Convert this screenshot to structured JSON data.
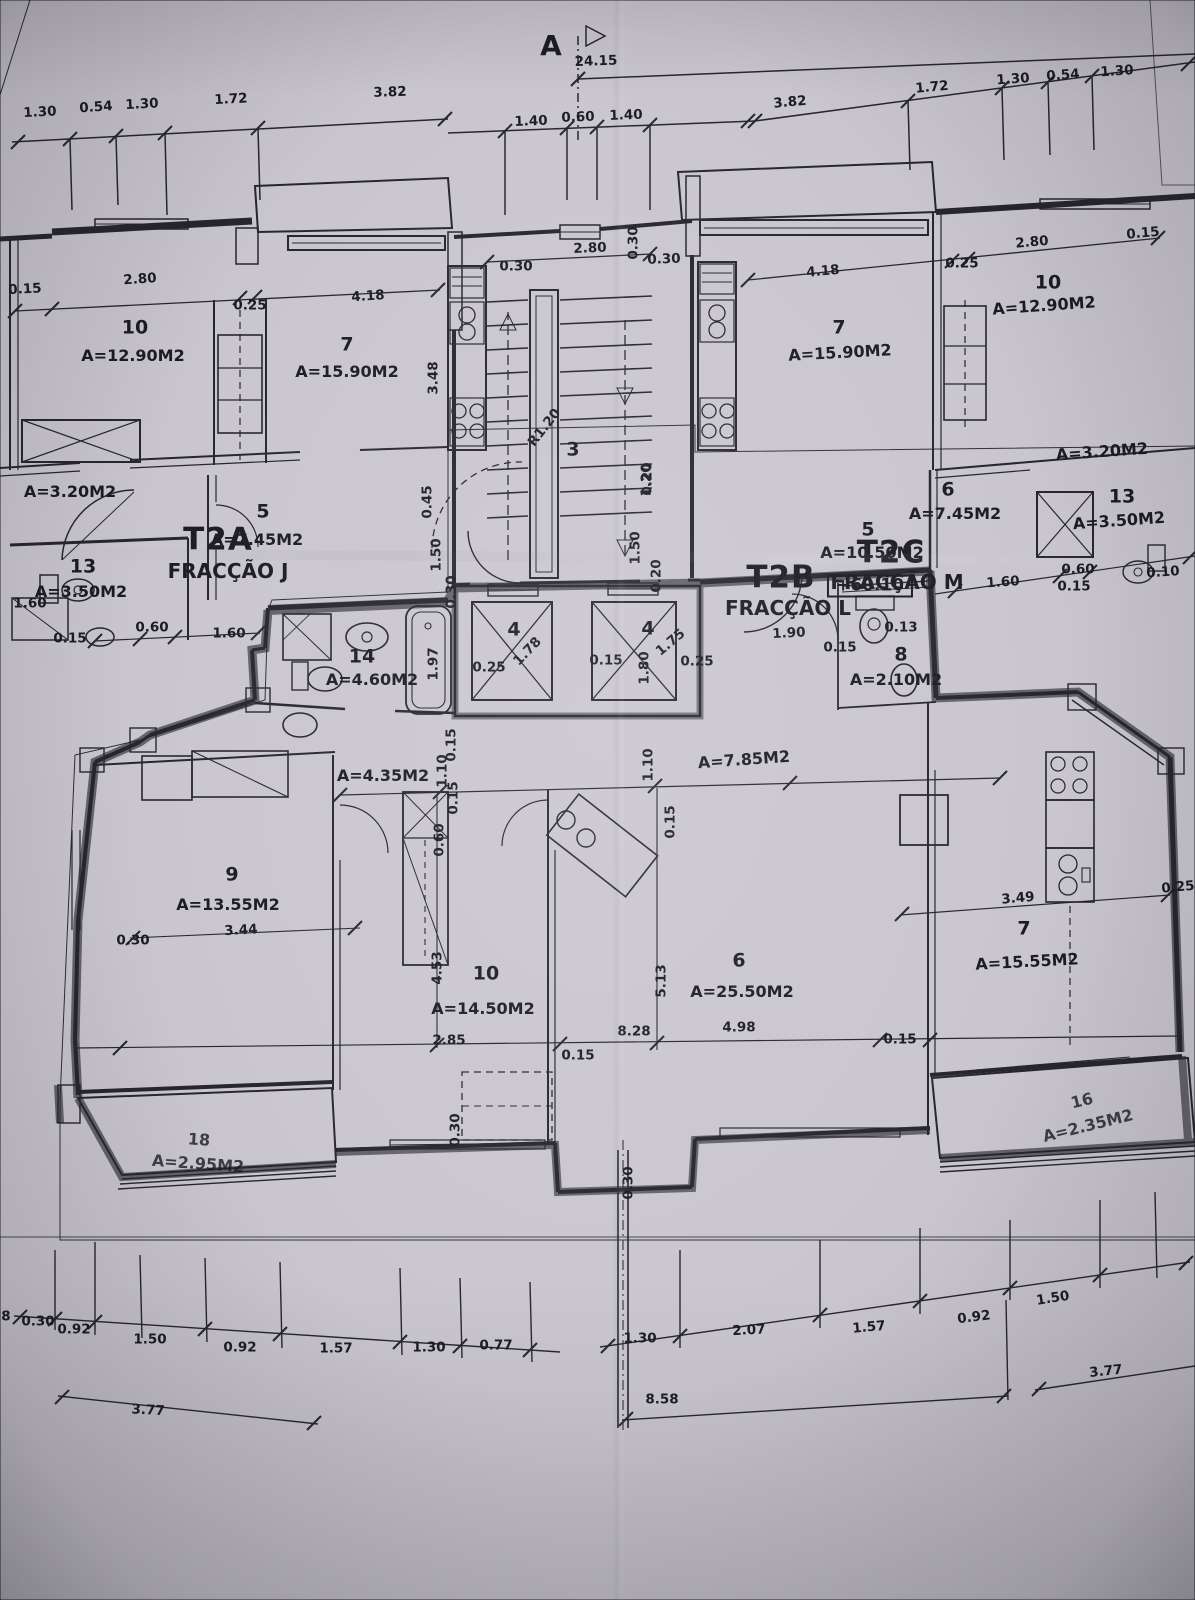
{
  "colors": {
    "paper": "#cac6cf",
    "paper_lower": "#c7cbd1",
    "ink": "#26262c",
    "label_ink": "#1b1b22",
    "highlight_green": "#d2e5de",
    "highlight_orange": "#ee9a31"
  },
  "plan": {
    "labels": {
      "top": [
        {
          "t": "A",
          "x": 551,
          "y": 46,
          "k": "marker"
        },
        {
          "t": "24.15",
          "x": 596,
          "y": 62,
          "r": -2,
          "k": "dim"
        },
        {
          "t": "1.30",
          "x": 40,
          "y": 113,
          "r": -3,
          "k": "dim"
        },
        {
          "t": "0.54",
          "x": 96,
          "y": 108,
          "r": -4,
          "k": "dim"
        },
        {
          "t": "1.30",
          "x": 142,
          "y": 105,
          "r": -3,
          "k": "dim"
        },
        {
          "t": "1.72",
          "x": 231,
          "y": 100,
          "r": -3,
          "k": "dim"
        },
        {
          "t": "3.82",
          "x": 390,
          "y": 93,
          "r": -2,
          "k": "dim"
        },
        {
          "t": "1.40",
          "x": 531,
          "y": 122,
          "r": -2,
          "k": "dim"
        },
        {
          "t": "0.60",
          "x": 578,
          "y": 118,
          "r": -2,
          "k": "dim"
        },
        {
          "t": "1.40",
          "x": 626,
          "y": 116,
          "r": -2,
          "k": "dim"
        },
        {
          "t": "3.82",
          "x": 790,
          "y": 103,
          "r": -5,
          "k": "dim"
        },
        {
          "t": "1.72",
          "x": 932,
          "y": 88,
          "r": -5,
          "k": "dim"
        },
        {
          "t": "1.30",
          "x": 1013,
          "y": 80,
          "r": -4,
          "k": "dim"
        },
        {
          "t": "0.54",
          "x": 1063,
          "y": 76,
          "r": -4,
          "k": "dim"
        },
        {
          "t": "1.30",
          "x": 1117,
          "y": 72,
          "r": -4,
          "k": "dim"
        }
      ],
      "upper_left": [
        {
          "t": "0.15",
          "x": 25,
          "y": 290,
          "r": -3,
          "k": "dim"
        },
        {
          "t": "2.80",
          "x": 140,
          "y": 280,
          "r": -4,
          "k": "dim"
        },
        {
          "t": "10",
          "x": 135,
          "y": 328,
          "k": "room"
        },
        {
          "t": "A=12.90M2",
          "x": 133,
          "y": 356,
          "k": "area"
        },
        {
          "t": "0.25",
          "x": 250,
          "y": 306,
          "k": "dim"
        },
        {
          "t": "4.18",
          "x": 368,
          "y": 297,
          "r": -4,
          "k": "dim"
        },
        {
          "t": "7",
          "x": 347,
          "y": 345,
          "k": "room"
        },
        {
          "t": "A=15.90M2",
          "x": 347,
          "y": 372,
          "k": "area"
        },
        {
          "t": "3.48",
          "x": 434,
          "y": 378,
          "r": -90,
          "k": "dim"
        },
        {
          "t": "0.45",
          "x": 428,
          "y": 502,
          "r": -90,
          "k": "dim"
        },
        {
          "t": "A=3.20M2",
          "x": 70,
          "y": 492,
          "k": "area"
        },
        {
          "t": "5",
          "x": 263,
          "y": 512,
          "k": "room"
        },
        {
          "t": "A=7.45M2",
          "x": 257,
          "y": 540,
          "k": "area"
        },
        {
          "t": "13",
          "x": 83,
          "y": 567,
          "k": "room"
        },
        {
          "t": "A=3.50M2",
          "x": 81,
          "y": 592,
          "k": "area"
        },
        {
          "t": "1.60",
          "x": 30,
          "y": 604,
          "k": "dim"
        },
        {
          "t": "0.15",
          "x": 70,
          "y": 639,
          "k": "dim"
        },
        {
          "t": "0.60",
          "x": 152,
          "y": 628,
          "k": "dim"
        },
        {
          "t": "1.60",
          "x": 229,
          "y": 634,
          "k": "dim"
        },
        {
          "t": "T2A",
          "x": 218,
          "y": 540,
          "k": "big"
        },
        {
          "t": "FRACÇÃO J",
          "x": 228,
          "y": 571,
          "k": "frac"
        },
        {
          "t": "1.50",
          "x": 437,
          "y": 555,
          "r": -90,
          "k": "dim"
        },
        {
          "t": "0.30",
          "x": 452,
          "y": 592,
          "r": -90,
          "k": "dim"
        }
      ],
      "stairs": [
        {
          "t": "0.30",
          "x": 516,
          "y": 267,
          "k": "dim"
        },
        {
          "t": "2.80",
          "x": 590,
          "y": 249,
          "r": -2,
          "k": "dim"
        },
        {
          "t": "0.30",
          "x": 664,
          "y": 260,
          "r": -2,
          "k": "dim"
        },
        {
          "t": "0.30",
          "x": 634,
          "y": 243,
          "r": -90,
          "k": "dim"
        },
        {
          "t": "3",
          "x": 573,
          "y": 450,
          "k": "room"
        },
        {
          "t": "R1.20",
          "x": 545,
          "y": 428,
          "r": -52,
          "k": "dim"
        },
        {
          "t": "1.20",
          "x": 647,
          "y": 480,
          "r": -90,
          "k": "dim"
        },
        {
          "t": "5",
          "x": 868,
          "y": 530,
          "k": "room"
        },
        {
          "t": "A=10.50M2",
          "x": 872,
          "y": 553,
          "k": "area"
        },
        {
          "t": "+60.10",
          "x": 870,
          "y": 586,
          "k": "level"
        },
        {
          "t": "1.50",
          "x": 636,
          "y": 548,
          "r": -90,
          "k": "dim"
        },
        {
          "t": "0.20",
          "x": 648,
          "y": 479,
          "r": -90,
          "k": "dim"
        },
        {
          "t": "0.20",
          "x": 657,
          "y": 576,
          "r": -90,
          "k": "dim"
        }
      ],
      "upper_right": [
        {
          "t": "T2B",
          "x": 781,
          "y": 578,
          "k": "big"
        },
        {
          "t": "FRACÇÃO L",
          "x": 788,
          "y": 608,
          "k": "frac"
        },
        {
          "t": "T2C",
          "x": 891,
          "y": 553,
          "k": "big"
        },
        {
          "t": "FRACÇÃO M",
          "x": 897,
          "y": 582,
          "k": "frac"
        },
        {
          "t": "6",
          "x": 948,
          "y": 490,
          "k": "room"
        },
        {
          "t": "A=7.45M2",
          "x": 955,
          "y": 514,
          "k": "area"
        },
        {
          "t": "1.60",
          "x": 1003,
          "y": 583,
          "r": -4,
          "k": "dim"
        },
        {
          "t": "4.18",
          "x": 823,
          "y": 272,
          "r": -5,
          "k": "dim"
        },
        {
          "t": "7",
          "x": 839,
          "y": 328,
          "k": "room"
        },
        {
          "t": "A=15.90M2",
          "x": 840,
          "y": 353,
          "r": -3,
          "k": "area"
        },
        {
          "t": "0.25",
          "x": 962,
          "y": 264,
          "k": "dim"
        },
        {
          "t": "2.80",
          "x": 1032,
          "y": 243,
          "r": -5,
          "k": "dim"
        },
        {
          "t": "10",
          "x": 1048,
          "y": 283,
          "k": "room"
        },
        {
          "t": "A=12.90M2",
          "x": 1044,
          "y": 306,
          "r": -4,
          "k": "area"
        },
        {
          "t": "0.15",
          "x": 1143,
          "y": 234,
          "r": -5,
          "k": "dim"
        },
        {
          "t": "A=3.20M2",
          "x": 1102,
          "y": 452,
          "r": -4,
          "k": "area"
        },
        {
          "t": "13",
          "x": 1122,
          "y": 497,
          "k": "room"
        },
        {
          "t": "A=3.50M2",
          "x": 1119,
          "y": 521,
          "r": -4,
          "k": "area"
        },
        {
          "t": "0.60",
          "x": 1078,
          "y": 570,
          "k": "dim"
        },
        {
          "t": "0.15",
          "x": 1074,
          "y": 587,
          "k": "dim"
        },
        {
          "t": "0.10",
          "x": 1163,
          "y": 573,
          "r": -4,
          "k": "dim"
        }
      ],
      "apartment": [
        {
          "t": "14",
          "x": 362,
          "y": 657,
          "k": "room"
        },
        {
          "t": "A=4.60M2",
          "x": 372,
          "y": 680,
          "k": "area"
        },
        {
          "t": "1.97",
          "x": 434,
          "y": 664,
          "r": -90,
          "k": "dim"
        },
        {
          "t": "0.25",
          "x": 489,
          "y": 668,
          "k": "dim"
        },
        {
          "t": "4",
          "x": 514,
          "y": 630,
          "k": "room"
        },
        {
          "t": "1.78",
          "x": 528,
          "y": 652,
          "r": -46,
          "k": "dim"
        },
        {
          "t": "0.15",
          "x": 606,
          "y": 661,
          "k": "dim"
        },
        {
          "t": "4",
          "x": 648,
          "y": 629,
          "k": "room"
        },
        {
          "t": "1.75",
          "x": 671,
          "y": 643,
          "r": -40,
          "k": "dim"
        },
        {
          "t": "1.80",
          "x": 645,
          "y": 668,
          "r": -90,
          "k": "dim"
        },
        {
          "t": "0.25",
          "x": 697,
          "y": 662,
          "k": "dim"
        },
        {
          "t": "1.90",
          "x": 789,
          "y": 634,
          "r": -3,
          "k": "dim"
        },
        {
          "t": "0.15",
          "x": 840,
          "y": 648,
          "k": "dim"
        },
        {
          "t": "0.13",
          "x": 901,
          "y": 628,
          "k": "dim"
        },
        {
          "t": "8",
          "x": 901,
          "y": 655,
          "k": "room"
        },
        {
          "t": "A=2.10M2",
          "x": 896,
          "y": 680,
          "k": "area"
        },
        {
          "t": "A=4.35M2",
          "x": 383,
          "y": 776,
          "k": "area"
        },
        {
          "t": "0.15",
          "x": 452,
          "y": 745,
          "r": -90,
          "k": "dim"
        },
        {
          "t": "1.10",
          "x": 443,
          "y": 771,
          "r": -90,
          "k": "dim"
        },
        {
          "t": "0.15",
          "x": 454,
          "y": 798,
          "r": -90,
          "k": "dim"
        },
        {
          "t": "0.60",
          "x": 440,
          "y": 840,
          "r": -90,
          "k": "dim"
        },
        {
          "t": "A=7.85M2",
          "x": 744,
          "y": 760,
          "r": -4,
          "k": "area"
        },
        {
          "t": "1.10",
          "x": 649,
          "y": 765,
          "r": -90,
          "k": "dim"
        },
        {
          "t": "0.15",
          "x": 671,
          "y": 822,
          "r": -90,
          "k": "dim"
        },
        {
          "t": "9",
          "x": 232,
          "y": 875,
          "k": "room"
        },
        {
          "t": "A=13.55M2",
          "x": 228,
          "y": 905,
          "k": "area"
        },
        {
          "t": "3.44",
          "x": 241,
          "y": 931,
          "r": -3,
          "k": "dim"
        },
        {
          "t": "0.30",
          "x": 133,
          "y": 941,
          "k": "dim"
        },
        {
          "t": "4.53",
          "x": 438,
          "y": 968,
          "r": -90,
          "k": "dim"
        },
        {
          "t": "10",
          "x": 486,
          "y": 974,
          "k": "room"
        },
        {
          "t": "A=14.50M2",
          "x": 483,
          "y": 1009,
          "k": "area"
        },
        {
          "t": "2.85",
          "x": 449,
          "y": 1041,
          "k": "dim"
        },
        {
          "t": "0.15",
          "x": 578,
          "y": 1056,
          "k": "dim"
        },
        {
          "t": "8.28",
          "x": 634,
          "y": 1032,
          "k": "dim"
        },
        {
          "t": "5.13",
          "x": 662,
          "y": 981,
          "r": -90,
          "k": "dim"
        },
        {
          "t": "6",
          "x": 739,
          "y": 961,
          "k": "room"
        },
        {
          "t": "A=25.50M2",
          "x": 742,
          "y": 992,
          "k": "area"
        },
        {
          "t": "4.98",
          "x": 739,
          "y": 1028,
          "k": "dim"
        },
        {
          "t": "0.15",
          "x": 900,
          "y": 1040,
          "k": "dim"
        },
        {
          "t": "3.49",
          "x": 1018,
          "y": 899,
          "r": -5,
          "k": "dim"
        },
        {
          "t": "7",
          "x": 1024,
          "y": 929,
          "k": "room"
        },
        {
          "t": "A=15.55M2",
          "x": 1027,
          "y": 962,
          "r": -3,
          "k": "area"
        },
        {
          "t": "0.25",
          "x": 1178,
          "y": 888,
          "r": -5,
          "k": "dim"
        },
        {
          "t": "16",
          "x": 1082,
          "y": 1101,
          "r": -14,
          "k": "balc"
        },
        {
          "t": "A=2.35M2",
          "x": 1088,
          "y": 1126,
          "r": -14,
          "k": "balc"
        },
        {
          "t": "18",
          "x": 199,
          "y": 1140,
          "r": 4,
          "k": "balc"
        },
        {
          "t": "A=2.95M2",
          "x": 198,
          "y": 1164,
          "r": 4,
          "k": "balc"
        },
        {
          "t": "0.30",
          "x": 456,
          "y": 1130,
          "r": -90,
          "k": "dim"
        },
        {
          "t": "0.30",
          "x": 629,
          "y": 1183,
          "r": -90,
          "k": "dim"
        }
      ],
      "bottom": [
        {
          "t": "8",
          "x": 6,
          "y": 1317,
          "k": "dim"
        },
        {
          "t": "0.30",
          "x": 38,
          "y": 1322,
          "k": "dim"
        },
        {
          "t": "0.92",
          "x": 74,
          "y": 1330,
          "k": "dim"
        },
        {
          "t": "1.50",
          "x": 150,
          "y": 1340,
          "k": "dim"
        },
        {
          "t": "0.92",
          "x": 240,
          "y": 1348,
          "k": "dim"
        },
        {
          "t": "1.57",
          "x": 336,
          "y": 1349,
          "k": "dim"
        },
        {
          "t": "1.30",
          "x": 429,
          "y": 1348,
          "k": "dim"
        },
        {
          "t": "0.77",
          "x": 496,
          "y": 1346,
          "k": "dim"
        },
        {
          "t": "1.30",
          "x": 640,
          "y": 1339,
          "k": "dim"
        },
        {
          "t": "2.07",
          "x": 749,
          "y": 1331,
          "r": -3,
          "k": "dim"
        },
        {
          "t": "1.57",
          "x": 869,
          "y": 1328,
          "r": -5,
          "k": "dim"
        },
        {
          "t": "0.92",
          "x": 974,
          "y": 1318,
          "r": -7,
          "k": "dim"
        },
        {
          "t": "1.50",
          "x": 1053,
          "y": 1299,
          "r": -9,
          "k": "dim"
        },
        {
          "t": "3.77",
          "x": 148,
          "y": 1411,
          "r": 3,
          "k": "dim"
        },
        {
          "t": "8.58",
          "x": 662,
          "y": 1400,
          "k": "dim"
        },
        {
          "t": "3.77",
          "x": 1106,
          "y": 1372,
          "r": -6,
          "k": "dim"
        }
      ]
    }
  }
}
